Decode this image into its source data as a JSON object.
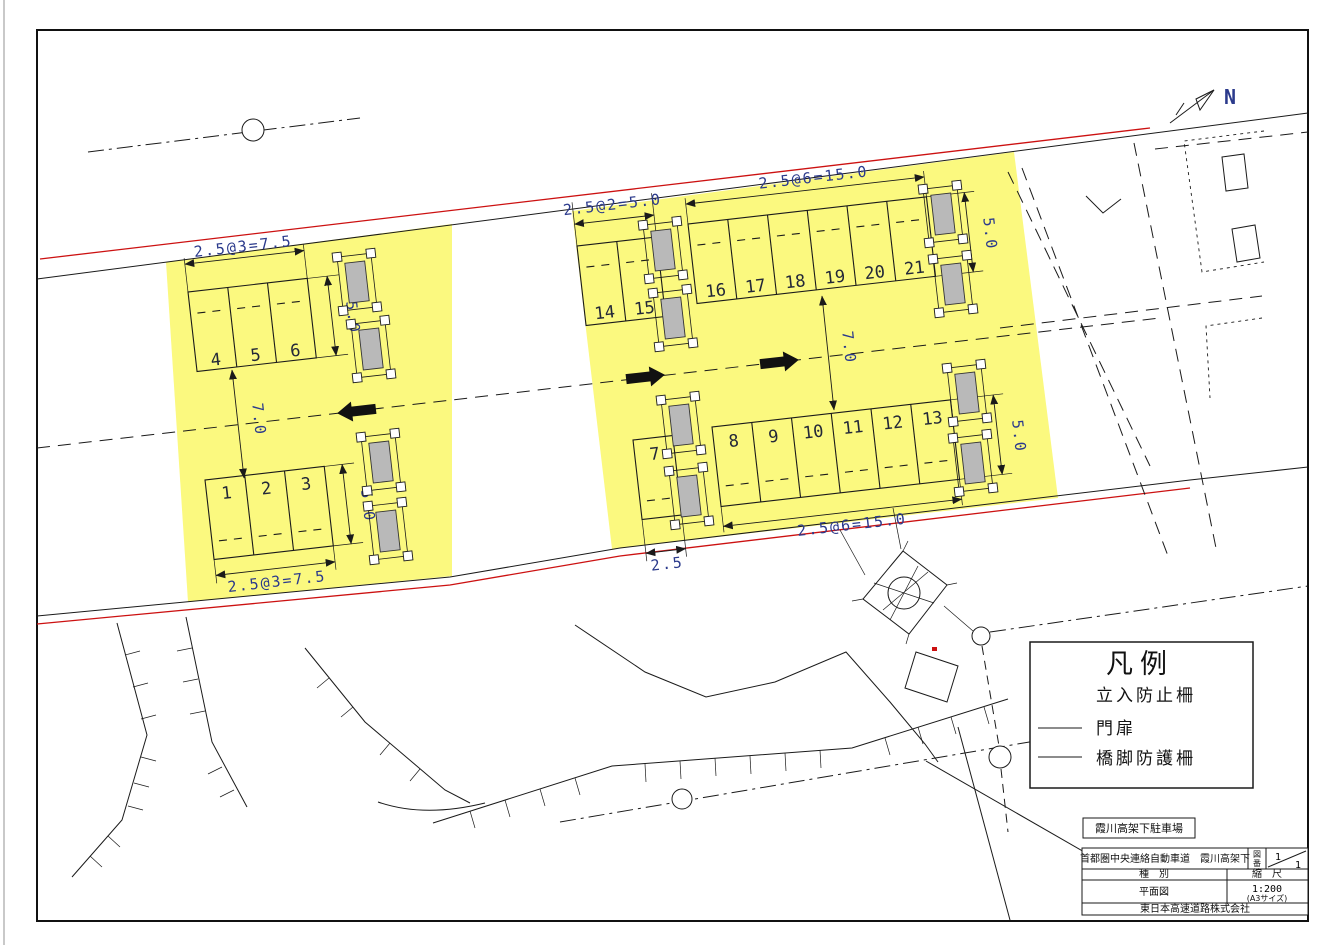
{
  "north_label": "N",
  "dims": {
    "left_top": "2.5@3=7.5",
    "left_bottom": "2.5@3=7.5",
    "two_bay": "2.5@2=5.0",
    "six_bay_top": "2.5@6=15.0",
    "six_bay_bottom": "2.5@6=15.0",
    "bay_depth": "5.0",
    "road_width": "7.0",
    "single_bay": "2.5"
  },
  "stalls": {
    "b123": [
      "1",
      "2",
      "3"
    ],
    "b456": [
      "4",
      "5",
      "6"
    ],
    "b7": [
      "7"
    ],
    "b813": [
      "8",
      "9",
      "10",
      "11",
      "12",
      "13"
    ],
    "b1415": [
      "14",
      "15"
    ],
    "b1621": [
      "16",
      "17",
      "18",
      "19",
      "20",
      "21"
    ]
  },
  "legend": {
    "title": "凡例",
    "items": [
      "立入防止柵",
      "門扉",
      "橋脚防護柵"
    ]
  },
  "stamp": {
    "site_label": "霞川高架下駐車場"
  },
  "title_block": {
    "project": "首都圏中央連絡自動車道　霞川高架下",
    "sheet_label_chars": [
      "図",
      "番"
    ],
    "sheet_top": "1",
    "sheet_bottom": "1",
    "col_type_label": "種　別",
    "col_scale_label": "縮　尺",
    "type_value": "平面図",
    "scale_value": "1:200",
    "scale_size": "(A3サイズ)",
    "company": "東日本高速道路株式会社"
  },
  "colors": {
    "highlight": "#FBF97F",
    "fence_red": "#CC1111",
    "dim_text": "#2B3A8C",
    "pier_gray": "#B9B9B9"
  }
}
